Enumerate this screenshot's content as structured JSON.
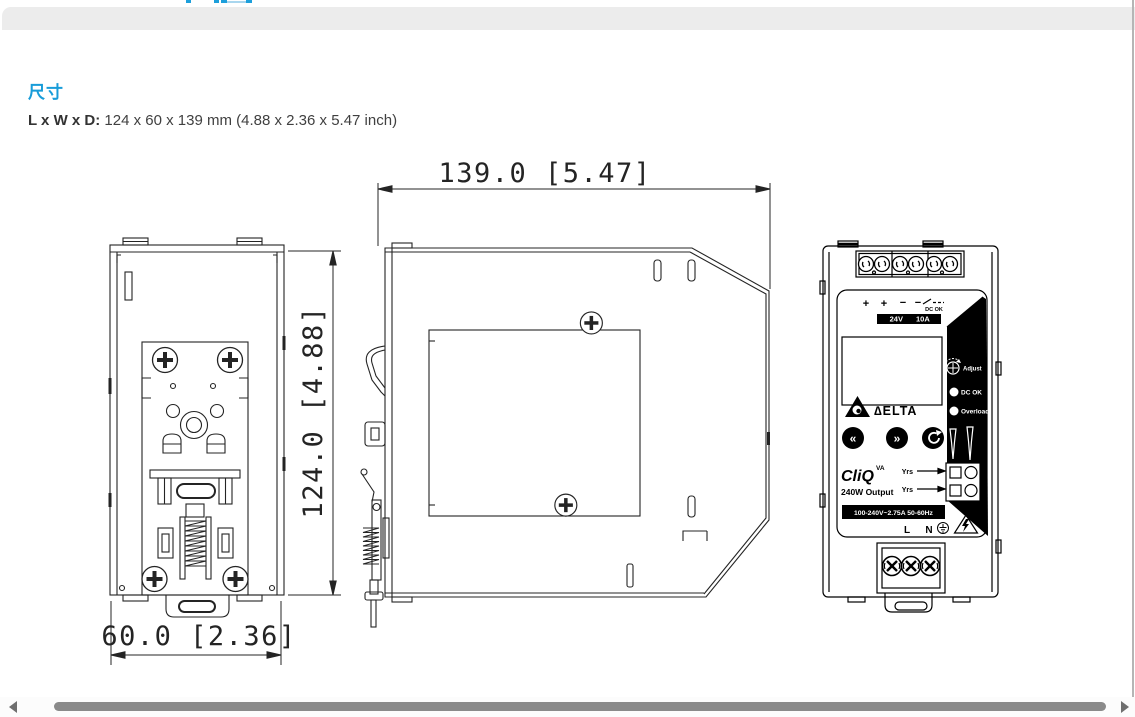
{
  "section": {
    "title": "尺寸",
    "dims_label": "L x W x D:",
    "dims_value": "124 x 60 x 139 mm (4.88 x 2.36 x 5.47 inch)"
  },
  "dims": {
    "depth": "139.0 [5.47]",
    "height": "124.0 [4.88]",
    "width": "60.0 [2.36]"
  },
  "product": {
    "polarity": [
      "+",
      "+",
      "−",
      "−"
    ],
    "dc_ok_switch_label": "DC OK",
    "rating_voltage": "24V",
    "rating_current": "10A",
    "brand": "∆ELTA",
    "model": "CliQ",
    "model_sup": "VA",
    "output": "240W Output",
    "adjust": "Adjust",
    "led1": "DC OK",
    "led2": "Overload",
    "yrs1": "Yrs",
    "yrs2": "Yrs",
    "input_rating": "100-240V~2.75A 50-60Hz",
    "line": "L",
    "neutral": "N"
  },
  "colors": {
    "accent": "#189cd9",
    "band": "#ececec",
    "scroll_thumb": "#8a8a8a"
  }
}
